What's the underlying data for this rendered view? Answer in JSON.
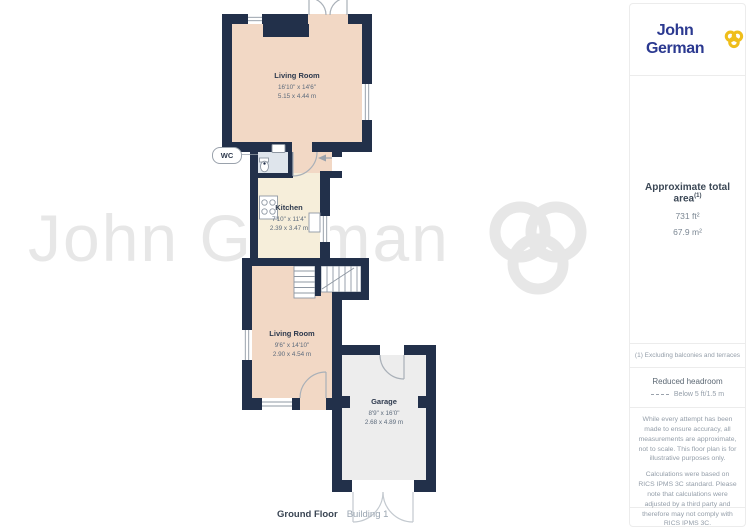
{
  "branding": {
    "logo_text": "John German"
  },
  "watermark": {
    "text": "John German"
  },
  "rooms": [
    {
      "name": "Living Room",
      "imperial": "16'10\" x 14'6\"",
      "metric": "5.15 x 4.44 m"
    },
    {
      "name": "Kitchen",
      "imperial": "7'10\" x 11'4\"",
      "metric": "2.39 x 3.47 m"
    },
    {
      "name": "Living Room",
      "imperial": "9'6\" x 14'10\"",
      "metric": "2.90 x 4.54 m"
    },
    {
      "name": "Garage",
      "imperial": "8'9\" x 16'0\"",
      "metric": "2.68 x 4.89 m"
    },
    {
      "name": "WC"
    }
  ],
  "sidebar": {
    "area_title": "Approximate total area",
    "area_sup": "(1)",
    "area_imperial": "731 ft²",
    "area_metric": "67.9 m²",
    "footnote": "(1) Excluding balconies and terraces",
    "headroom_title": "Reduced headroom",
    "headroom_legend": "Below 5 ft/1.5 m",
    "disclaimer_1": "While every attempt has been made to ensure accuracy, all measurements are approximate, not to scale. This floor plan is for illustrative purposes only.",
    "disclaimer_2": "Calculations were based on RICS IPMS 3C standard. Please note that calculations were adjusted by a third party and therefore may not comply with RICS IPMS 3C.",
    "brand_name": "GIRAFFE",
    "brand_suffix": "360"
  },
  "footer": {
    "floor_label": "Ground Floor",
    "building_label": "Building 1"
  },
  "colors": {
    "wall": "#22304a",
    "floor_living": "#f2d8c5",
    "floor_kitchen": "#f6eeda",
    "floor_wc": "#dfe5ec",
    "floor_garage": "#ededed",
    "logo_blue": "#2b3990",
    "logo_gold": "#efbe1b",
    "watermark_gray": "#e7e7e7"
  }
}
